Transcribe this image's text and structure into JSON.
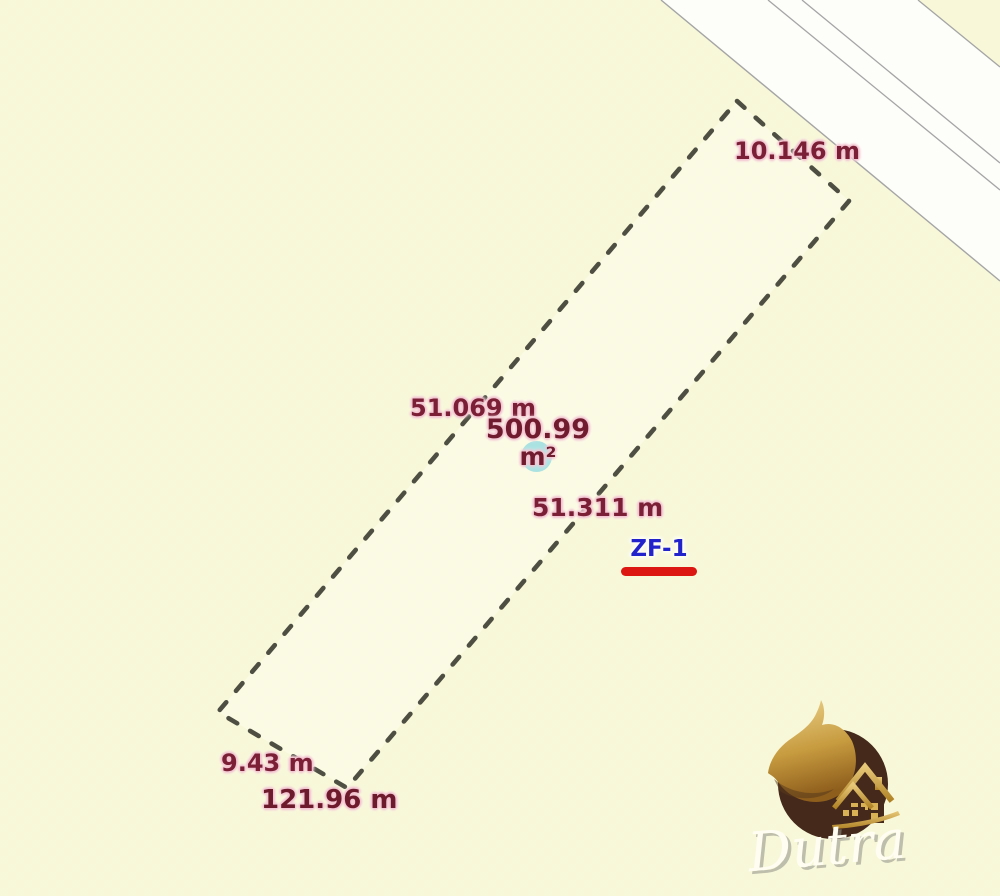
{
  "map": {
    "measurements": {
      "top_side": "10.146 m",
      "left_side": "51.069 m",
      "right_side": "51.311 m",
      "bottom_side": "9.43 m",
      "perimeter": "121.96 m",
      "area_value": "500.99",
      "area_unit": "m²"
    },
    "zone_label": "ZF-1",
    "colors": {
      "background": "#f8f8d8",
      "road_fill": "#fdfdfa",
      "road_line": "#a5a5a5",
      "parcel_fill": "#fbfbe6",
      "parcel_dash": "#4e4e42",
      "measurement_text": "#7a1f35",
      "measurement_halo": "#f2c3d0",
      "zone_text": "#2323cb",
      "zone_underline": "#dc1712",
      "area_marker": "#8fd9e0"
    }
  },
  "logo": {
    "brand": "Dutra",
    "gold": "#c79b3f",
    "brown": "#45291b"
  }
}
